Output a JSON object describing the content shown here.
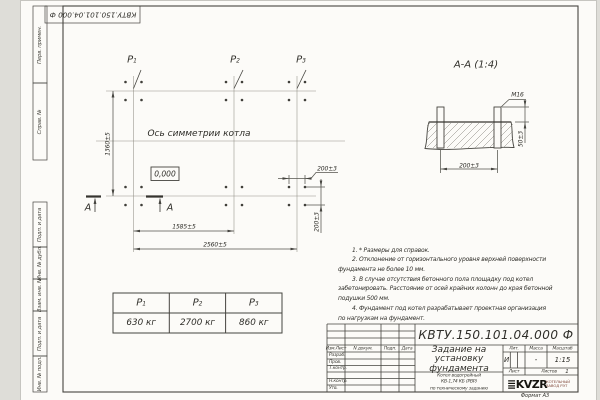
{
  "sheet": {
    "doc_number_top": "КВТУ.150.101.04.000 Ф",
    "format_note": "Формат А3"
  },
  "margin_labels": {
    "perv_primen": "Перв. примен.",
    "sprav_n": "Справ. №",
    "podp_data_1": "Подп. и дата",
    "inv_dubl": "Инв. № дубл.",
    "vzam_inv": "Взам. инв. №",
    "podp_data_2": "Подп. и дата",
    "inv_podl": "Инв. № подл."
  },
  "plan": {
    "axis_label": "Ось симметрии котла",
    "elevation": "0,000",
    "p1": {
      "base": "P",
      "sub": "1"
    },
    "p2": {
      "base": "P",
      "sub": "2"
    },
    "p3": {
      "base": "P",
      "sub": "3"
    },
    "dim_height": "1360±5",
    "dim_span1": "1585±5",
    "dim_span2": "2560±5",
    "dim_bolt_x": "200±3",
    "dim_bolt_y": "200±3",
    "section_letter": "А"
  },
  "section": {
    "title": "А-А (1:4)",
    "thread": "М16",
    "dim_width": "200±3",
    "dim_height": "50±3"
  },
  "notes": [
    {
      "t": "1. * Размеры для справок."
    },
    {
      "t": "2. Отклонение от горизонтального уровня верхней поверхности"
    },
    {
      "t": "фундамента не более 10 мм."
    },
    {
      "t": "3. В случае отсутствия бетонного пола площадку под котел"
    },
    {
      "t": "забетонировать. Расстояние от осей крайних колонн до края бетонной"
    },
    {
      "t": "подушки 500 мм."
    },
    {
      "t": "4. Фундамент под котел разрабатывает проектная организация"
    },
    {
      "t": "по нагрузкам на фундамент."
    }
  ],
  "load_table": {
    "headers": [
      {
        "base": "P",
        "sub": "1"
      },
      {
        "base": "P",
        "sub": "2"
      },
      {
        "base": "P",
        "sub": "3"
      }
    ],
    "values": [
      "630 кг",
      "2700 кг",
      "860 кг"
    ]
  },
  "title_block": {
    "doc_number": "КВТУ.150.101.04.000 Ф",
    "cols": {
      "izm": "Изм.Лист",
      "doc": "N докум.",
      "podp": "Подп.",
      "data": "Дата"
    },
    "rows": {
      "razrab": "Разраб.",
      "prov": "Пров.",
      "tkontr": "Т.контр.",
      "nkontr": "Н.контр.",
      "utv": "Утв."
    },
    "title_lines": [
      "Задание на",
      "установку",
      "фундамента"
    ],
    "object_lines": [
      "Котел водогрейный",
      "КВ-1,74 КБ (РВР)",
      "по техническому заданию"
    ],
    "lit_label": "Лит.",
    "mass_label": "Масса",
    "scale_label": "Масштаб",
    "lit": "И",
    "mass": "-",
    "scale": "1:15",
    "sheet_label": "Лист",
    "sheets_label": "Листов",
    "sheets_value": "1",
    "logo_text": "KVZR",
    "logo_sub1": "КОТЕЛЬНЫЙ",
    "logo_sub2": "ЗАВОД РЭТ"
  }
}
